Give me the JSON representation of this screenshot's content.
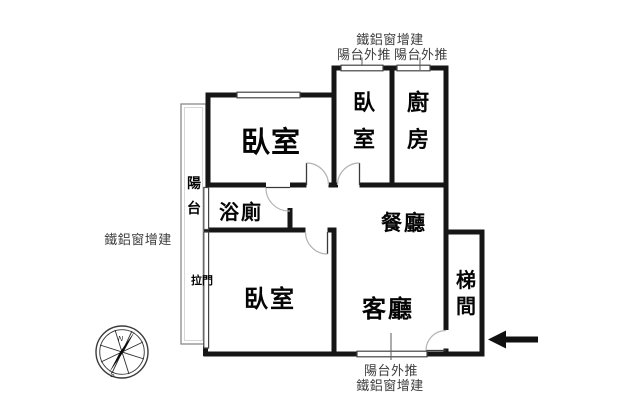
{
  "floorplan": {
    "rooms": {
      "master_bedroom": "臥室",
      "upper_bedroom": "臥室",
      "kitchen": "廚房",
      "bathroom": "浴廁",
      "dining_room": "餐廳",
      "lower_bedroom": "臥室",
      "living_room": "客廳",
      "stairwell": "梯間",
      "balcony": "陽台",
      "sliding_door": "拉門"
    },
    "annotations": {
      "top_window_addition": "鐵鋁窗增建",
      "top_balcony_push_left": "陽台外推",
      "top_balcony_push_right": "陽台外推",
      "left_window_addition": "鐵鋁窗增建",
      "bottom_balcony_push": "陽台外推",
      "bottom_window_addition": "鐵鋁窗增建"
    },
    "compass": {
      "north_label": "N",
      "south_label": "S"
    },
    "colors": {
      "wall": "#161616",
      "annotation_text": "#3d3d3d",
      "room_text": "#000000",
      "background": "#ffffff"
    }
  }
}
